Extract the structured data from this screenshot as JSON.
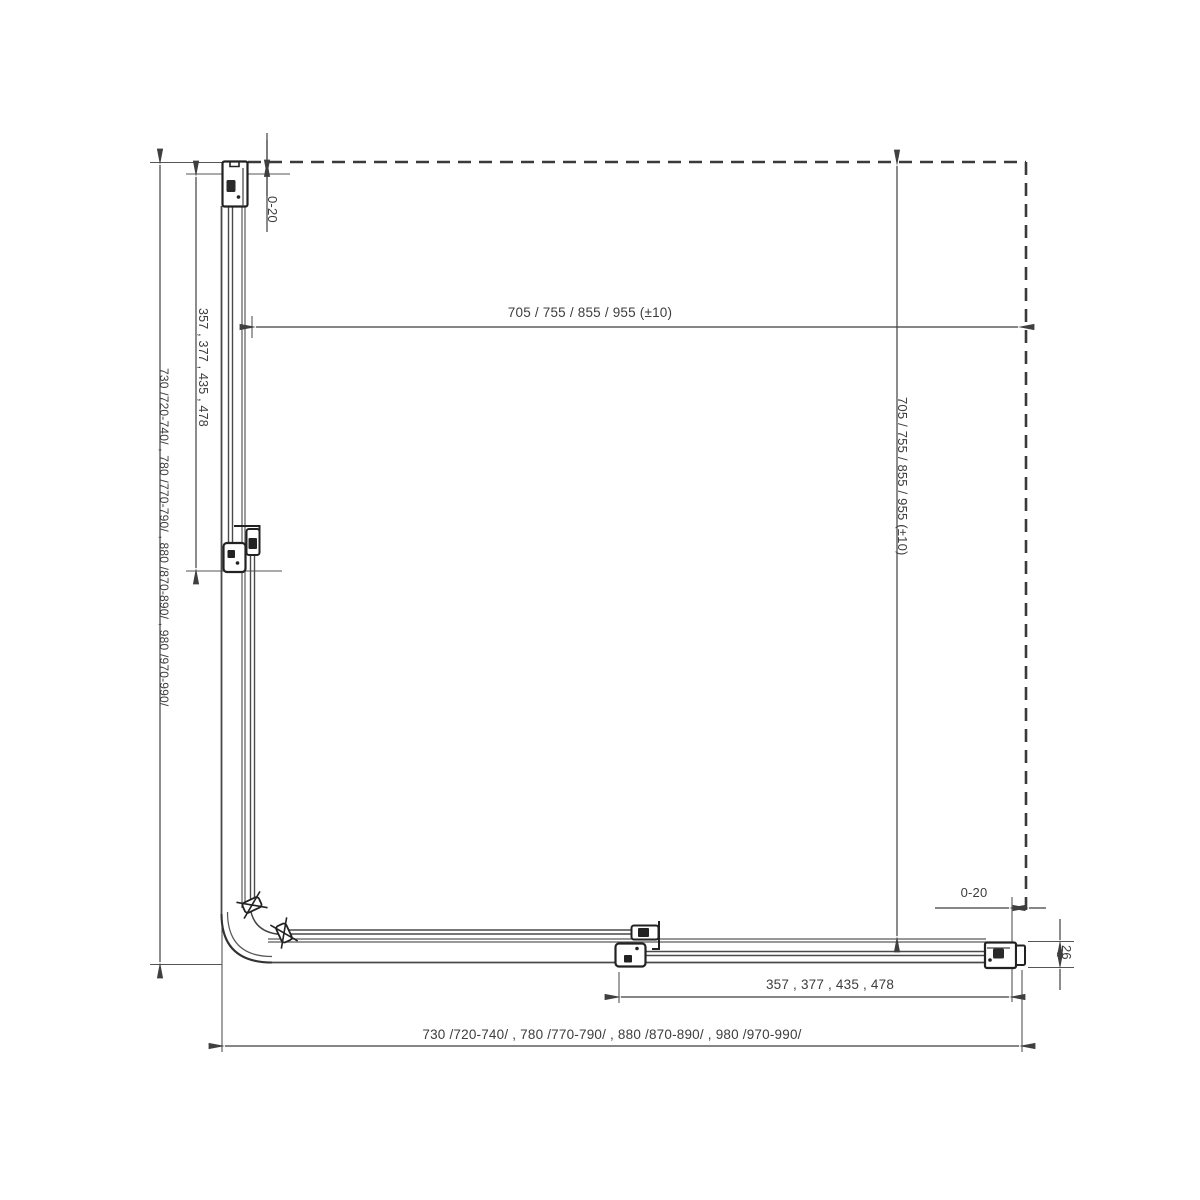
{
  "drawing": {
    "background": "#ffffff",
    "line_color": "#3f3f3f",
    "dimensions": {
      "top_width": "705 / 755 / 855 / 955 (±10)",
      "right_height": "705 / 755 / 855 / 955 (±10)",
      "left_fixed": "357 , 377 , 435 , 478",
      "bottom_fixed": "357 , 377 , 435 , 478",
      "left_total": "730  /720-740/ , 780  /770-790/ , 880  /870-890/ , 980  /970-990/",
      "bottom_total": "730  /720-740/ , 780  /770-790/ , 880  /870-890/ , 980  /970-990/",
      "top_gap": "0-20",
      "right_gap": "0-20",
      "profile_depth": "26"
    }
  }
}
